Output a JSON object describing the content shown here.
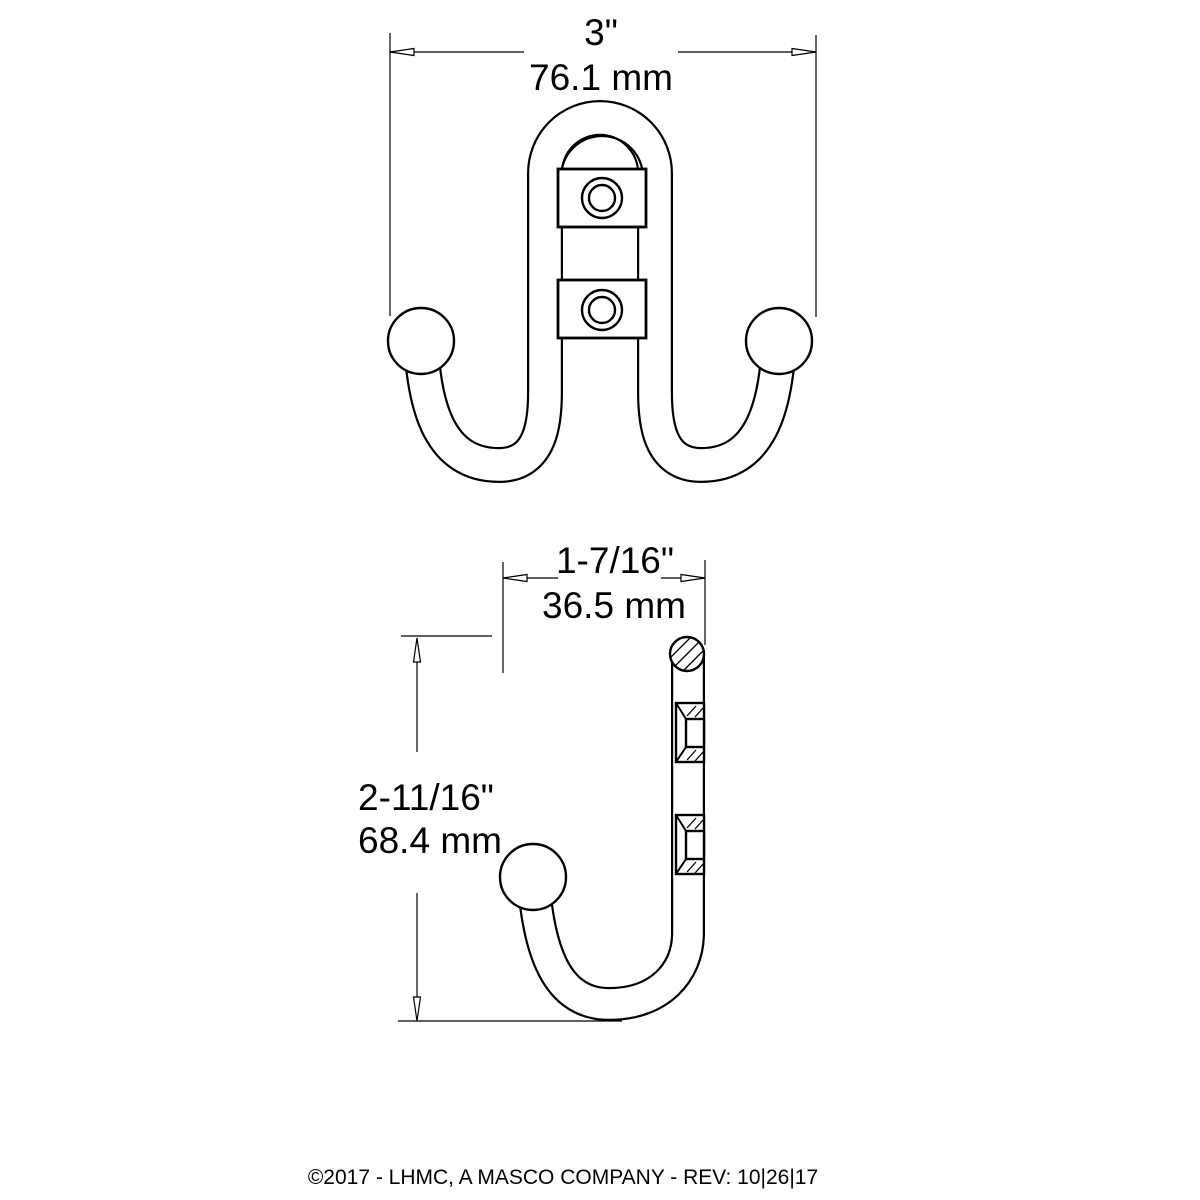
{
  "front_view": {
    "width_dim": {
      "inches": "3\"",
      "mm": "76.1 mm"
    }
  },
  "side_view": {
    "depth_dim": {
      "inches": "1-7/16\"",
      "mm": "36.5 mm"
    },
    "height_dim": {
      "inches": "2-11/16\"",
      "mm": "68.4 mm"
    }
  },
  "footer": {
    "copyright": "©2017 - LHMC, A MASCO COMPANY - REV: 10|26|17"
  },
  "colors": {
    "line": "#000000",
    "background": "#ffffff"
  }
}
